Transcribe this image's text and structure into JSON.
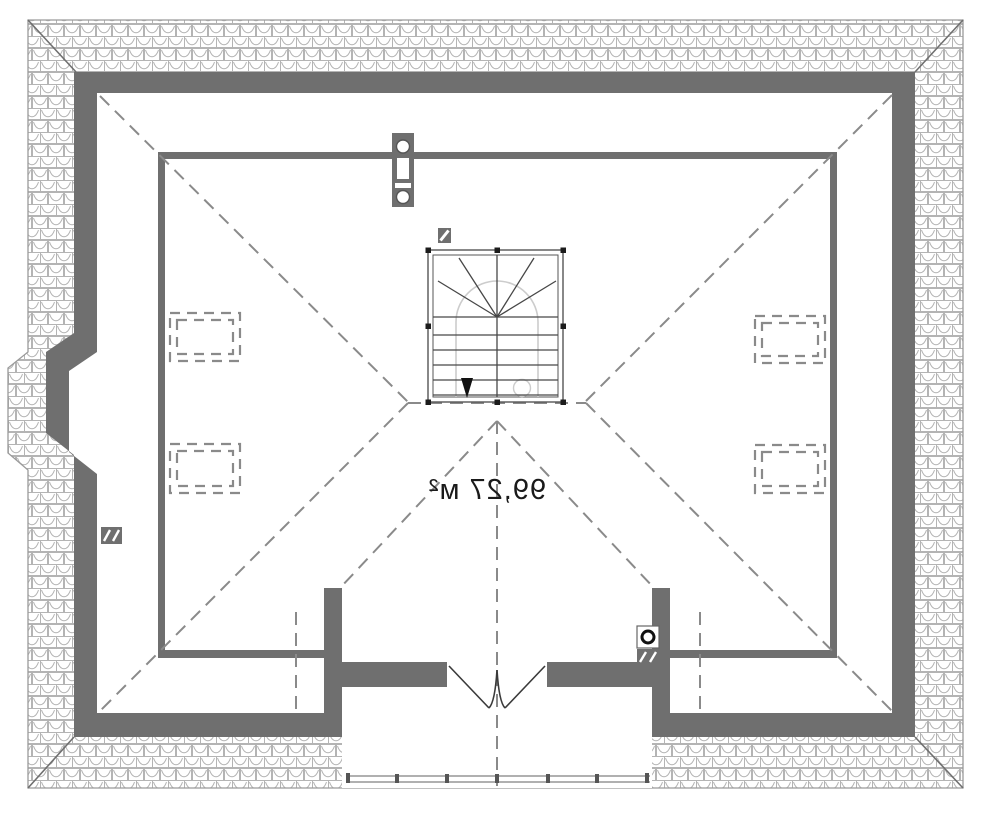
{
  "floorplan": {
    "area_label": "99,27 м²",
    "colors": {
      "wall": "#6f6f6f",
      "roof_line": "#8a8a8a",
      "thin_line": "#9a9a9a",
      "stair_line": "#474747",
      "ink": "#1a1a1a",
      "walk_line": "#cccccc",
      "door_line": "#3a3a3a"
    },
    "symbols": {
      "roof_tile_border": "scalloped-roof-tile-hatch",
      "chimney_top": "chimney-block-two-round-flues",
      "vent_small": "vent-square-diagonal-slash",
      "vent_left_wall": "double-vent-squares",
      "chimney_right": "round-flue-with-vent-box",
      "skylight": "dashed-roof-window",
      "staircase": "winder-stair-going-down",
      "entrance_door": "double-swing-door",
      "balcony_railing": "post-and-rail"
    },
    "notes": {
      "label_orientation": "mirrored"
    }
  }
}
